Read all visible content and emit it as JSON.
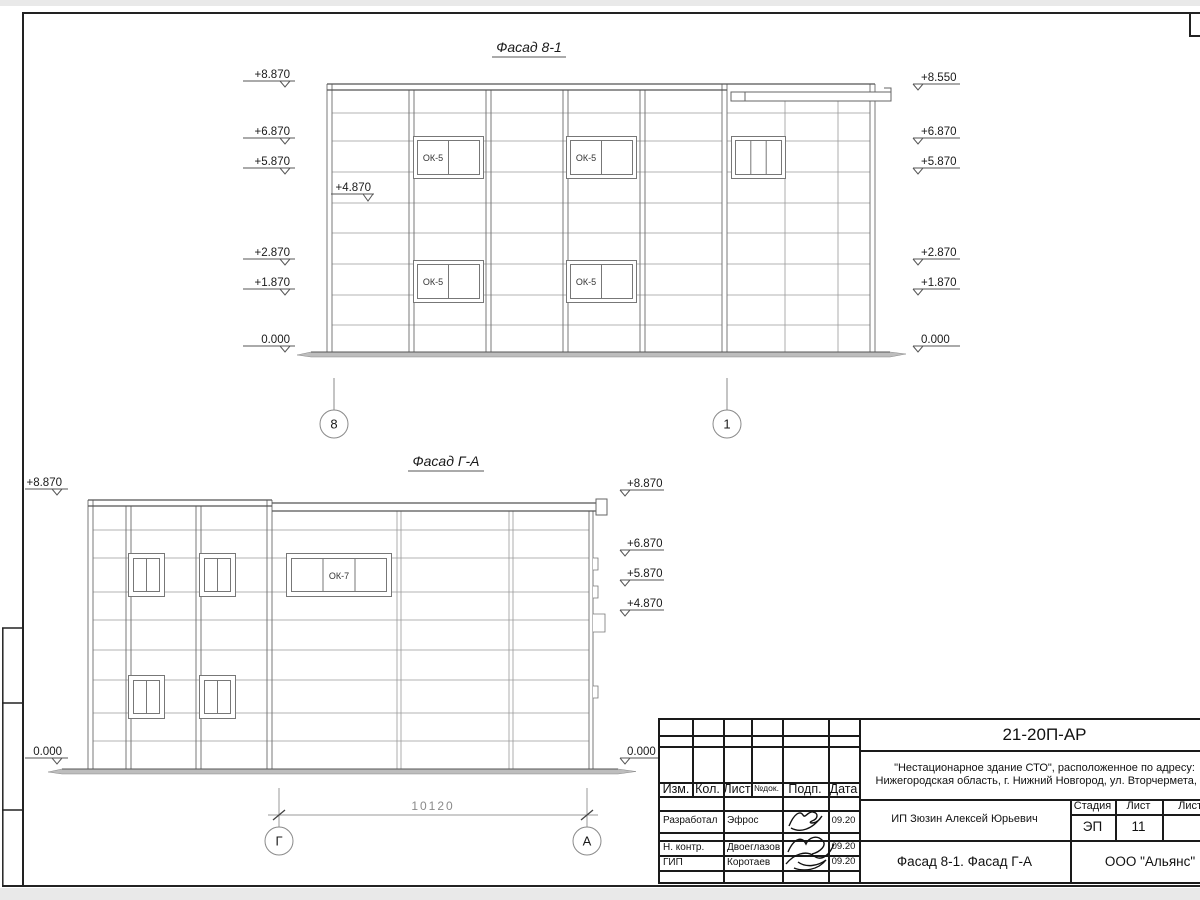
{
  "facade_8_1": {
    "title": "Фасад 8-1",
    "left_marks": [
      "+8.870",
      "+6.870",
      "+5.870",
      "+2.870",
      "+1.870",
      "0.000"
    ],
    "intermediate_mark": "+4.870",
    "right_marks": [
      "+8.550",
      "+6.870",
      "+5.870",
      "+2.870",
      "+1.870",
      "0.000"
    ],
    "window_label": "ОК-5",
    "axes": [
      "8",
      "1"
    ]
  },
  "facade_g_a": {
    "title": "Фасад Г-А",
    "left_marks": [
      "+8.870",
      "0.000"
    ],
    "right_marks": [
      "+8.870",
      "+6.870",
      "+5.870",
      "+4.870",
      "0.000"
    ],
    "window_label": "ОК-7",
    "axes": [
      "Г",
      "А"
    ],
    "dimension": "10120"
  },
  "title_block": {
    "code": "21-20П-АР",
    "project_line1": "\"Нестационарное здание СТО\", расположенное по адресу:",
    "project_line2": "Нижегородская область, г. Нижний Новгород, ул. Вторчермета, 1А",
    "col_izm": "Изм.",
    "col_kol": "Кол.",
    "col_list": "Лист",
    "col_ndok": "№док.",
    "col_podp": "Подп.",
    "col_data": "Дата",
    "rows": [
      {
        "role": "Разработал",
        "name": "Эфрос",
        "date": "09.20"
      },
      {
        "role": "Н. контр.",
        "name": "Двоеглазов",
        "date": "09.20"
      },
      {
        "role": "ГИП",
        "name": "Коротаев",
        "date": "09.20"
      }
    ],
    "stage_label": "Стадия",
    "sheet_label": "Лист",
    "sheets_label": "Листов",
    "stage_value": "ЭП",
    "sheet_value": "11",
    "client": "ИП Зюзин Алексей Юрьевич",
    "doc_title": "Фасад 8-1. Фасад Г-А",
    "company": "ООО \"Альянс\""
  }
}
